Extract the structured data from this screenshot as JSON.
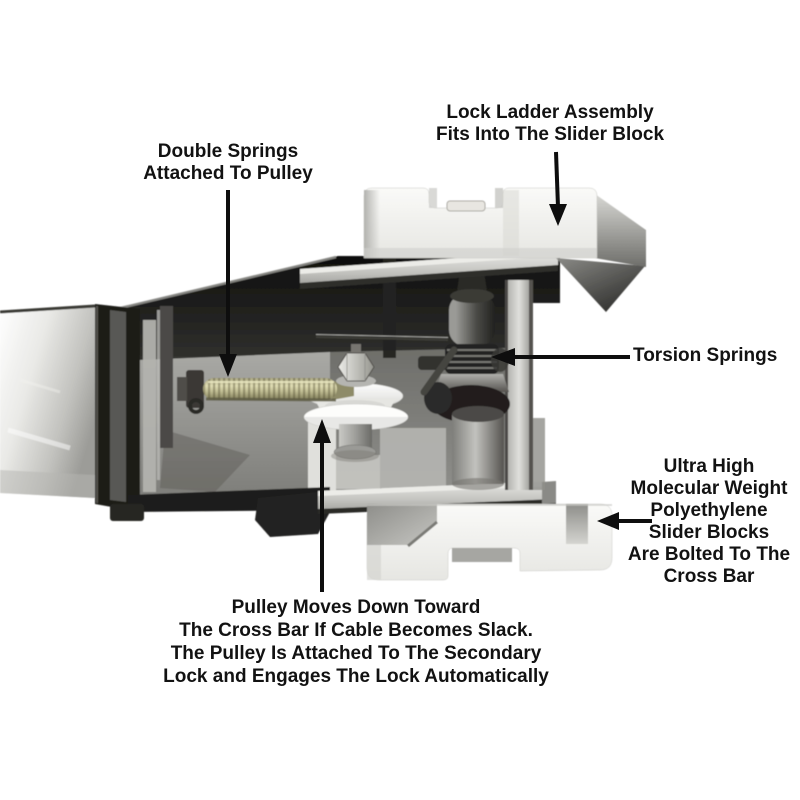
{
  "annotations": {
    "lock_ladder": "Lock Ladder Assembly\nFits Into The Slider Block",
    "double_springs": "Double Springs\nAttached To Pulley",
    "torsion_springs": "Torsion Springs",
    "slider_blocks": "Ultra High\nMolecular Weight\nPolyethylene\nSlider Blocks\nAre Bolted To The\nCross Bar",
    "pulley": "Pulley Moves Down Toward\nThe Cross Bar If Cable Becomes Slack.\nThe Pulley Is Attached To The Secondary\nLock and Engages The Lock Automatically"
  },
  "colors": {
    "background": "#ffffff",
    "annotation_text": "#121212",
    "arrow": "#0e0e0e",
    "spring_gold": "#c6c39a",
    "metal_light": "#e8e8e5",
    "metal_dark": "#1d1d1b"
  }
}
